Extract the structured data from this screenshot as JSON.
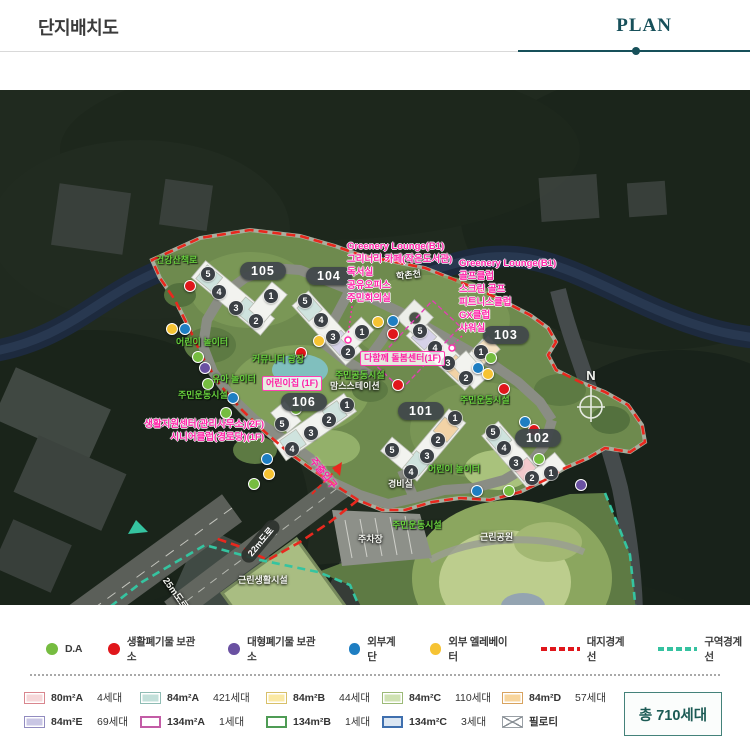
{
  "header": {
    "title": "단지배치도",
    "tab": "PLAN"
  },
  "map": {
    "stream": "학촌천",
    "north": "N",
    "ann_left": {
      "l0": "Greenery Lounge(B1)",
      "l1": "그리너리 카페(작은도서관)",
      "l2": "독서실",
      "l3": "공유오피스",
      "l4": "주민회의실"
    },
    "ann_right": {
      "l0": "Greenery Lounge(B1)",
      "l1": "골프클럽",
      "l2": "스크린 골프",
      "l3": "피트니스클럽",
      "l4": "GX클럽",
      "l5": "샤워실"
    },
    "badges": {
      "b101": "101",
      "b102": "102",
      "b103": "103",
      "b104": "104",
      "b105": "105",
      "b106": "106"
    },
    "pink": {
      "support": "생활지원센터(관리사무소)(2F)",
      "senior": "시니어클럽(경로당)(1F)",
      "daycare": "어린이집 (1F)",
      "care": "다함께 돌봄센터(1F)",
      "entrance": "주출입구"
    },
    "green": {
      "trail": "건강산책로",
      "play1": "어린이 놀이터",
      "plaza": "커뮤니티 광장",
      "toddler": "유아 놀이터",
      "sports_left": "주민운동시설",
      "community": "주민공동시설",
      "sports_102": "주민운동시설",
      "play2": "어린이 놀이터",
      "sports_park": "주민운동시설"
    },
    "white": {
      "moms": "맘스스테이션",
      "guard": "경비실",
      "parking": "주차장",
      "retail": "근린생활시설",
      "park": "근린공원"
    },
    "roads": {
      "r22": "22m도로",
      "r25": "25m도로"
    },
    "chips105": [
      "5",
      "4",
      "3",
      "2",
      "1"
    ],
    "chips104": [
      "5",
      "4",
      "3",
      "2",
      "1"
    ],
    "chipsC": [
      "5",
      "4",
      "3",
      "2",
      "1"
    ],
    "chips106": [
      "1",
      "2",
      "3",
      "4",
      "5"
    ],
    "chips101": [
      "1",
      "2",
      "3",
      "4",
      "5"
    ],
    "chips102": [
      "5",
      "4",
      "3",
      "2",
      "1"
    ]
  },
  "legend": {
    "markers": [
      {
        "label": "D.A",
        "color": "#76bc40"
      },
      {
        "label": "생활폐기물 보관소",
        "color": "#e0161b"
      },
      {
        "label": "대형폐기물 보관소",
        "color": "#6a51a2"
      },
      {
        "label": "외부계단",
        "color": "#1e7ec2"
      },
      {
        "label": "외부 엘레베이터",
        "color": "#f6c333"
      }
    ],
    "lines": [
      {
        "label": "대지경계선",
        "color": "#e0161b"
      },
      {
        "label": "구역경계선",
        "color": "#35c2a0"
      }
    ],
    "units": [
      {
        "name": "80m²A",
        "count": "4세대",
        "fill": "#f6d7d9",
        "border": "#d9868e"
      },
      {
        "name": "84m²A",
        "count": "421세대",
        "fill": "#c2e0da",
        "border": "#8fbcb4"
      },
      {
        "name": "84m²B",
        "count": "44세대",
        "fill": "#fbe9a4",
        "border": "#d8c06a"
      },
      {
        "name": "84m²C",
        "count": "110세대",
        "fill": "#cfe2b2",
        "border": "#9cba77"
      },
      {
        "name": "84m²D",
        "count": "57세대",
        "fill": "#f8d59c",
        "border": "#d8a35f"
      },
      {
        "name": "84m²E",
        "count": "69세대",
        "fill": "#c9c6e4",
        "border": "#928cc0"
      },
      {
        "name": "134m²A",
        "count": "1세대",
        "fill": "#ffffff",
        "border": "#c35ca6"
      },
      {
        "name": "134m²B",
        "count": "1세대",
        "fill": "#ffffff",
        "border": "#4f9c55"
      },
      {
        "name": "134m²C",
        "count": "3세대",
        "fill": "#dbe6f2",
        "border": "#3f6fae"
      },
      {
        "name": "필로티",
        "count": "",
        "fill": "#ffffff",
        "border": "#9aa0a6"
      }
    ],
    "total": "총 710세대"
  }
}
